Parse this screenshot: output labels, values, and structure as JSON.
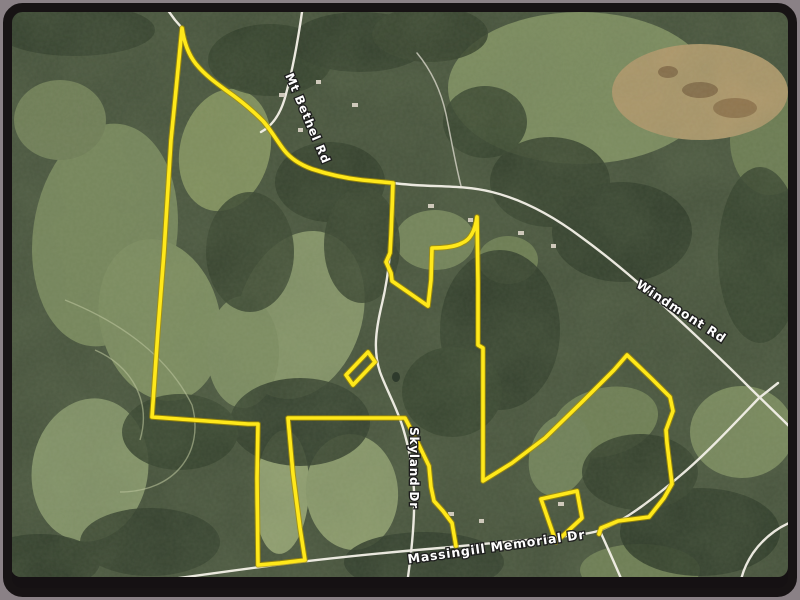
{
  "map": {
    "kind": "satellite-property-view",
    "colors": {
      "outer_band": "#8a8186",
      "frame": "#151113",
      "base_green": "#46523c",
      "boundary": "#ffe81a",
      "boundary_casing": "#a78f00",
      "road": "#f4f1e8",
      "label_fill": "#ffffff"
    },
    "road_labels": [
      {
        "name": "mt-bethel-rd",
        "text": "Mt Bethel Rd",
        "x": "304",
        "y": "120",
        "transform": "rotate(67 304 120)",
        "size": "12"
      },
      {
        "name": "windmont-rd",
        "text": "Windmont Rd",
        "x": "679",
        "y": "315",
        "transform": "rotate(33 679 315)",
        "size": "12.5"
      },
      {
        "name": "skyland-dr",
        "text": "Skyland Dr",
        "x": "410",
        "y": "468",
        "transform": "rotate(90 410 468)",
        "size": "12"
      },
      {
        "name": "massingill-memorial-dr",
        "text": "Massingill Memorial Dr",
        "x": "497",
        "y": "551",
        "transform": "rotate(-8 497 551)",
        "size": "12.5"
      }
    ],
    "paths": {
      "boundary_main": "M456,546 L452,523 L443,511 L434,501 L431,487 L429,466 L417,441 L405,418 L288,418 L293,474 L300,528 L305,560 L280,563 L258,565 L257,478 L258,424 L248,424 L152,417 L158,330 L164,252 L171,140 L176,90 L182,28 C184,42 188,54 196,64 C205,75 216,83 227,91 C240,100 252,110 263,121 C271,130 277,141 284,150 C291,159 301,165 312,169 C327,174 344,178 362,180 L393,183 L392,210 L391,235 L390,253 L386,262 L391,273 L392,281 L428,306 L431,280 L432,248 C441,248 455,247 462,243 C470,240 475,231 477,217 L478,282 L478,345 L483,348 L483,481 L512,463 L545,438 L582,402 L614,370 L627,355 L652,379 L670,397 L673,411 L666,430 L667,443 L672,484 L664,498 L649,517 L618,521 L601,528 L599,534",
      "outparcel_a": "M368,352 L375,362 L353,385 L346,375 Z",
      "outparcel_b": "M541,499 L577,491 L582,518 L556,542 Z",
      "road_stub_top": "M167,9 L175,20 L182,28",
      "road_windmont": "M393,183 C430,188 460,184 492,192 C524,200 553,216 581,237 C610,258 638,282 664,306 C690,330 718,356 742,380 C760,398 778,415 795,432",
      "road_mt_bethel": "M302,12 C298,40 293,68 286,94 C281,114 272,126 261,132",
      "road_skyland": "M392,186 L391,236 C390,262 387,284 381,308 C376,330 373,351 380,372 C387,391 397,408 403,428 C409,448 413,469 414,491 C415,519 412,548 408,577",
      "road_massingill": "M85,592 C140,583 200,575 260,567 C320,559 380,553 440,548 C480,544 520,541 558,537 C575,535 590,534 601,530 C628,519 655,497 681,475 C707,453 735,423 759,398 L778,383",
      "road_branch_south": "M600,531 C609,551 620,575 630,600",
      "road_branch_corner": "M800,519 C782,524 765,536 753,553 C747,562 743,571 741,580",
      "road_driveway": "M461,186 C455,162 451,138 446,114 C441,91 431,70 417,53"
    }
  }
}
